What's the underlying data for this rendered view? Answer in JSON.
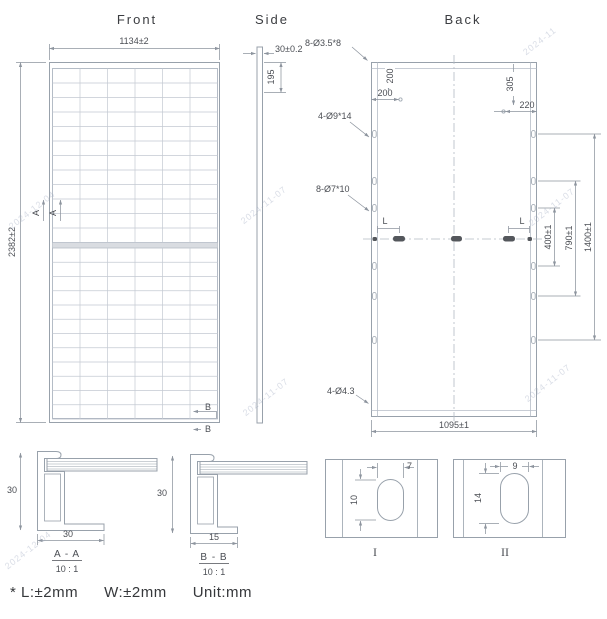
{
  "titles": {
    "front": "Front",
    "side": "Side",
    "back": "Back"
  },
  "front": {
    "width_dim": "1134±2",
    "height_dim": "2382±2",
    "section_a": "A",
    "section_b": "B"
  },
  "side": {
    "thickness_dim": "30±0.2",
    "edge_offset_dim": "195"
  },
  "back": {
    "labels": {
      "grounding_holes": "8-Ø3.5*8",
      "mounting_slots_large": "4-Ø9*14",
      "mounting_slots_small": "8-Ø7*10",
      "drain_holes": "4-Ø4.3"
    },
    "dims": {
      "top_left_vertical": "200",
      "top_left_horizontal": "200",
      "top_right_vertical": "305",
      "top_right_horizontal": "220",
      "slot_left": "L",
      "slot_right": "L",
      "span_inner": "400±1",
      "span_middle": "790±1",
      "span_outer": "1400±1",
      "bottom_width": "1095±1"
    }
  },
  "sections": {
    "aa": {
      "title": "A - A",
      "scale": "10 : 1",
      "height": "30",
      "width": "30"
    },
    "bb": {
      "title": "B - B",
      "scale": "10 : 1",
      "height": "30",
      "width": "15"
    }
  },
  "details": {
    "one": {
      "label": "I",
      "width": "7",
      "height": "10"
    },
    "two": {
      "label": "II",
      "width": "9",
      "height": "14"
    }
  },
  "note": {
    "p1": "* L:±2mm",
    "p2": "W:±2mm",
    "p3": "Unit:mm"
  },
  "watermarks": [
    "2024-12-04",
    "2024-12-04",
    "2024-11-07",
    "2024-11-07",
    "2024-11",
    "2024-11-07",
    "2024-11-07"
  ],
  "colors": {
    "object_line": "#98a1ab",
    "grid_line": "#c3c9d2",
    "dim_line": "#8d949e",
    "text": "#4b4e54",
    "slot_fill": "#54575c",
    "watermark": "#9ba5bc"
  }
}
